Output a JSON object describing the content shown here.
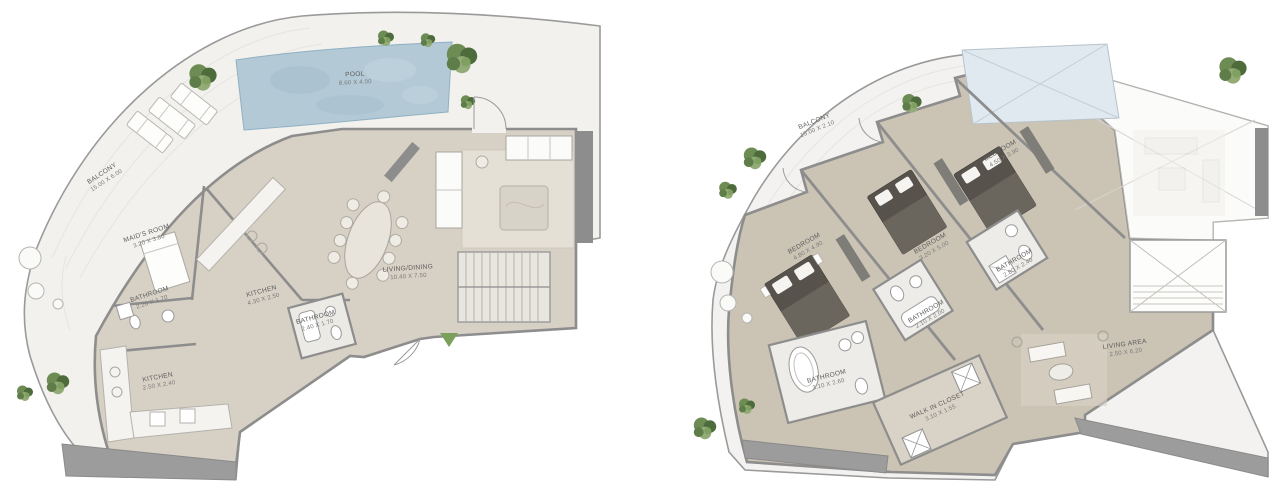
{
  "page": {
    "title": "Floor Plans",
    "background": "#ffffff"
  },
  "colors": {
    "balcony_floor": "#f2f1ee",
    "interior_floor_a": "#d7d0c5",
    "interior_floor_b": "#cbc3b4",
    "wall": "#8d8d8d",
    "pool_water": "#b3c9d6",
    "glass_skylight": "#dfe9ef",
    "tree_green": "#5e7d48",
    "entry_marker_green": "#7aa05c",
    "dark_wedge": "#9c9c9c"
  },
  "plan_a": {
    "balcony": {
      "label": "BALCONY",
      "dims": "15.00 X 6.00"
    },
    "pool": {
      "label": "POOL",
      "dims": "8.60 X 4.00"
    },
    "rooms": [
      {
        "label": "MAID'S ROOM",
        "dims": "3.20 X 3.80"
      },
      {
        "label": "BATHROOM",
        "dims": "2.20 X 1.70"
      },
      {
        "label": "KITCHEN",
        "dims": "4.30 X 2.50"
      },
      {
        "label": "BATHROOM",
        "dims": "2.40 X 1.70"
      },
      {
        "label": "LIVING/DINING",
        "dims": "10.40 X 7.50"
      },
      {
        "label": "KITCHEN",
        "dims": "2.50 X 2.40"
      }
    ]
  },
  "plan_b": {
    "balcony": {
      "label": "BALCONY",
      "dims": "15.00 X 2.10"
    },
    "rooms": [
      {
        "label": "BEDROOM",
        "dims": "4.50 X 3.90"
      },
      {
        "label": "BEDROOM",
        "dims": "4.80 X 4.90"
      },
      {
        "label": "BEDROOM",
        "dims": "3.20 X 5.00"
      },
      {
        "label": "BATHROOM",
        "dims": "2.80 X 2.40"
      },
      {
        "label": "BATHROOM",
        "dims": "2.10 X 2.00"
      },
      {
        "label": "BATHROOM",
        "dims": "3.10 X 2.60"
      },
      {
        "label": "WALK IN CLOSET",
        "dims": "3.10 X 1.55"
      },
      {
        "label": "LIVING AREA",
        "dims": "2.50 X 6.20"
      }
    ]
  }
}
